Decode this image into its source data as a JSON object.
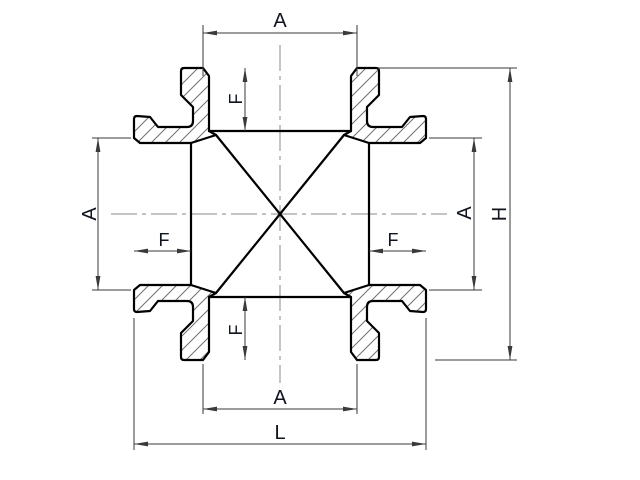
{
  "page": {
    "width": 640,
    "height": 480,
    "background": "#ffffff"
  },
  "drawing": {
    "type": "engineering-section-drawing",
    "subject": "four-way pipe cross fitting, full section view with hatched walls, centerlines and dimension callouts",
    "colors": {
      "outline": "#000000",
      "dimension": "#3a3a3a",
      "hatch": "#707070",
      "centerline": "#8a8a8a",
      "label": "#10141f"
    },
    "dims": {
      "top_width": {
        "label": "A",
        "orientation": "horizontal"
      },
      "bottom_width": {
        "label": "A",
        "orientation": "horizontal"
      },
      "left_height": {
        "label": "A",
        "orientation": "vertical"
      },
      "right_height": {
        "label": "A",
        "orientation": "vertical"
      },
      "top_depth": {
        "label": "F",
        "orientation": "vertical"
      },
      "bottom_depth": {
        "label": "F",
        "orientation": "vertical"
      },
      "left_depth": {
        "label": "F",
        "orientation": "horizontal"
      },
      "right_depth": {
        "label": "F",
        "orientation": "horizontal"
      },
      "overall_height": {
        "label": "H",
        "orientation": "vertical"
      },
      "overall_length": {
        "label": "L",
        "orientation": "horizontal"
      }
    }
  }
}
